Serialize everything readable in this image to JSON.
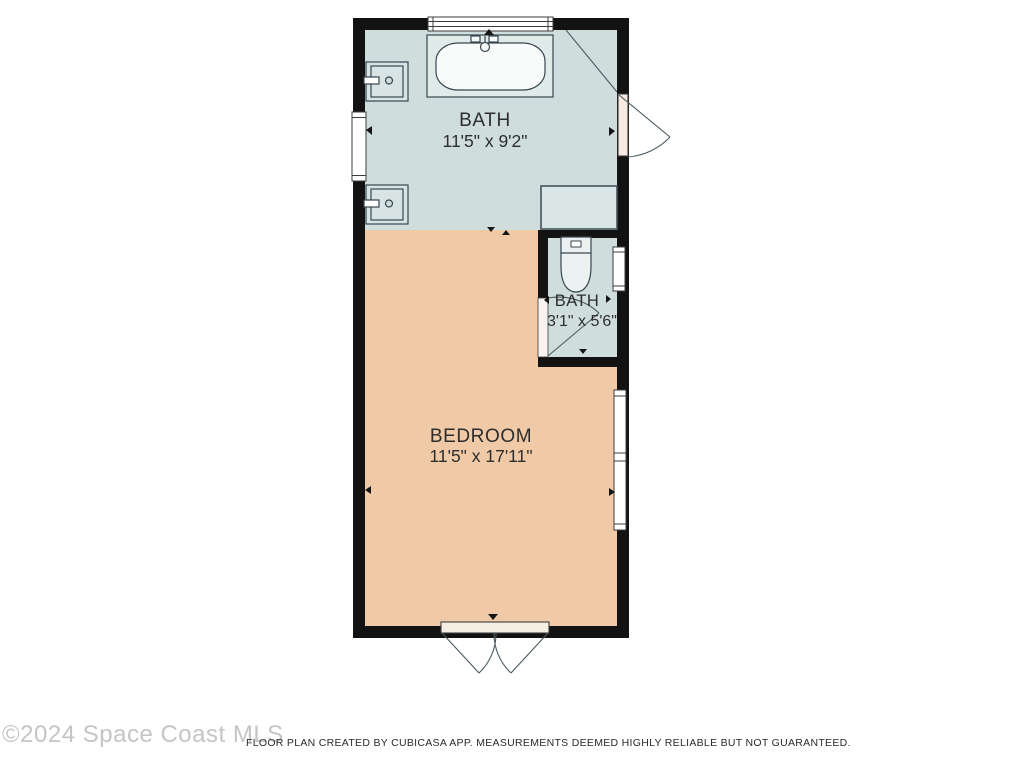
{
  "plan": {
    "rooms": {
      "bath": {
        "name": "BATH",
        "dims": "11'5\" x 9'2\""
      },
      "bath_small": {
        "name": "BATH",
        "dims": "3'1\" x 5'6\""
      },
      "bedroom": {
        "name": "BEDROOM",
        "dims": "11'5\" x 17'11\""
      }
    },
    "fixtures": {
      "bathtub": "bathtub",
      "sink_top": "sink-vanity",
      "sink_bottom": "sink-vanity",
      "toilet": "toilet",
      "shower": "shower-enclosure"
    },
    "colors": {
      "wall": "#121212",
      "bath_floor": "#cfdedd",
      "bedroom_floor": "#f0caa6",
      "shower_fill": "#dae6e5",
      "door_slab": "#f7eae3",
      "window_fill": "#ffffff"
    }
  },
  "footer": {
    "watermark": "©2024 Space Coast MLS",
    "disclaimer": "FLOOR PLAN CREATED BY CUBICASA APP. MEASUREMENTS DEEMED HIGHLY RELIABLE BUT NOT GUARANTEED."
  }
}
